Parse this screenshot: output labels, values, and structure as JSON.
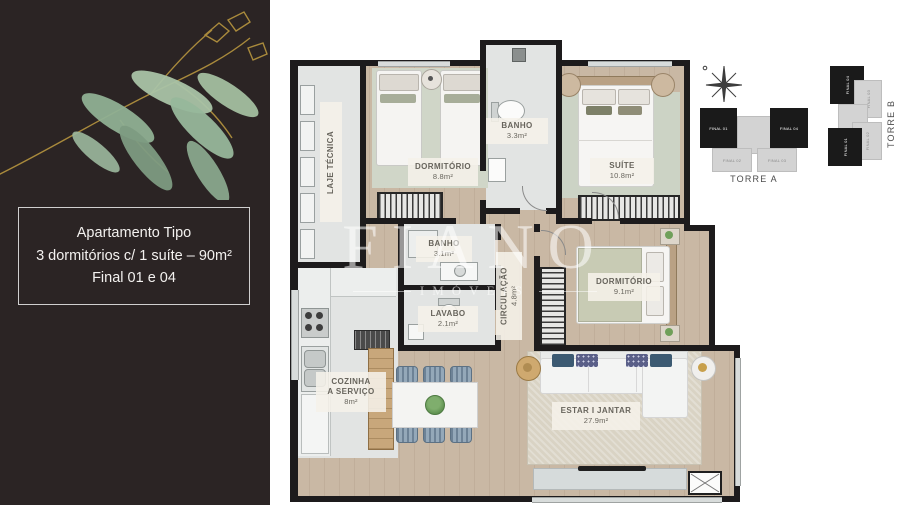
{
  "panel": {
    "line1": "Apartamento Tipo",
    "line2": "3 dormitórios c/ 1 suíte – 90m²",
    "line3": "Final 01 e 04"
  },
  "watermark": {
    "brand": "FIANO",
    "sub": "IMÓVEIS"
  },
  "plan": {
    "rooms": {
      "laje": {
        "name": "LAJE TÉCNICA"
      },
      "dorm1": {
        "name": "DORMITÓRIO",
        "area": "8.8m²"
      },
      "banho1": {
        "name": "BANHO",
        "area": "3.3m²"
      },
      "suite": {
        "name": "SUÍTE",
        "area": "10.8m²"
      },
      "banho2": {
        "name": "BANHO",
        "area": "3.1m²"
      },
      "lavabo": {
        "name": "LAVABO",
        "area": "2.1m²"
      },
      "circulacao": {
        "name": "CIRCULAÇÃO",
        "area": "4.8m²"
      },
      "dorm2": {
        "name": "DORMITÓRIO",
        "area": "9.1m²"
      },
      "cozinha": {
        "name1": "COZINHA",
        "name2": "A SERVIÇO",
        "area": "8m²"
      },
      "estar": {
        "name": "ESTAR I JANTAR",
        "area": "27.9m²"
      }
    }
  },
  "keyplan": {
    "torre_a": {
      "label": "TORRE A",
      "units": [
        {
          "label": "FINAL 01"
        },
        {
          "label": "FINAL 04"
        },
        {
          "label": "FINAL 02"
        },
        {
          "label": "FINAL 03"
        }
      ]
    },
    "torre_b": {
      "label": "TORRE B",
      "units": [
        {
          "label": "FINAL 04"
        },
        {
          "label": "FINAL 01"
        },
        {
          "label": "FINAL 03"
        },
        {
          "label": "FINAL 02"
        }
      ]
    }
  },
  "colors": {
    "panel_bg": "#2b2424",
    "wall": "#1d1b1c",
    "wood_floor": "#c9b8a4",
    "service_floor": "#e2e4e3",
    "sage_rug": "#d0d6c8",
    "living_rug": "#d9d3c4",
    "keyplan_highlight": "#1a1a1a",
    "keyplan_gray": "#d3d3d3"
  }
}
